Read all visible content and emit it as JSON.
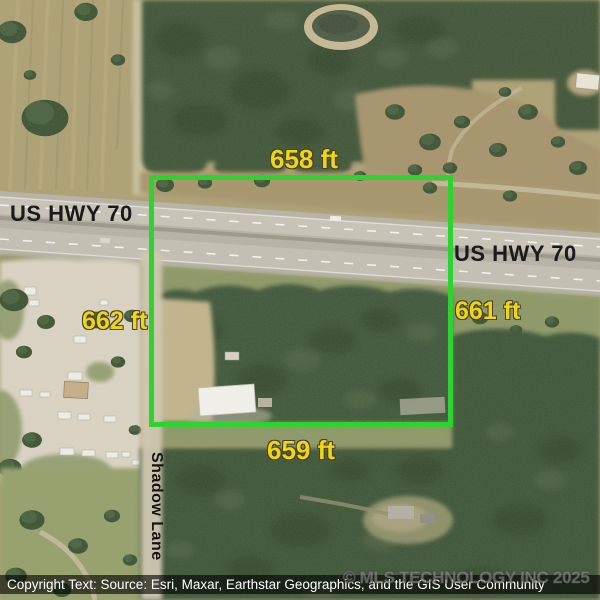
{
  "colors": {
    "boundary_green": "#2fd32f",
    "dimension_yellow": "#f2d411",
    "road_label_black": "#1a1a1a",
    "attribution_bg": "rgba(0,0,0,0.62)",
    "attribution_text": "#ffffff",
    "watermark_gray": "rgba(173,173,173,0.5)"
  },
  "parcel": {
    "dimension_top": "658 ft",
    "dimension_right": "661 ft",
    "dimension_bottom": "659 ft",
    "dimension_left": "662 ft"
  },
  "roads": {
    "highway_label_west": "US HWY 70",
    "highway_label_east": "US HWY 70",
    "street_label": "Shadow Lane"
  },
  "watermark": {
    "text": "© MLS TECHNOLOGY INC 2025"
  },
  "attribution": {
    "text": "Copyright Text: Source: Esri, Maxar, Earthstar Geographics, and the GIS User Community"
  }
}
